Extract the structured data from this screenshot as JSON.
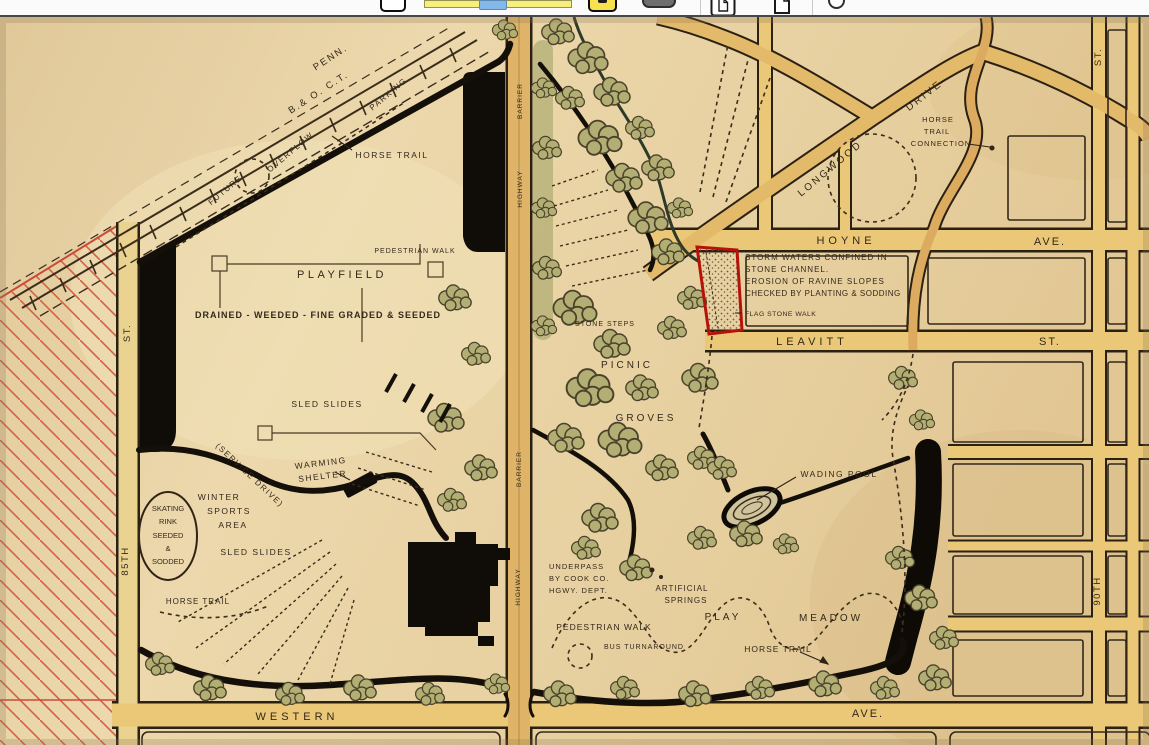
{
  "toolbar": {
    "icons": [
      "zoom-out-button",
      "zoom-slider",
      "zoom-in-button",
      "fit-width-button",
      "single-page-view-icon",
      "two-page-view-icon",
      "refresh-icon"
    ]
  },
  "map": {
    "railroad": {
      "penn": "PENN.",
      "boct": "B.& O. C.T."
    },
    "roads": {
      "future": "FUTURE",
      "overflow": "OVERFLOW",
      "parking": "PARKING",
      "longwood": "LONGWOOD",
      "drive": "DRIVE",
      "hoyne": "HOYNE",
      "hoyne_ave": "AVE.",
      "leavitt": "LEAVITT",
      "leavitt_st": "ST.",
      "western": "WESTERN",
      "western_ave": "AVE.",
      "st_left": "ST.",
      "st_85": "85TH",
      "st_right": "ST.",
      "st_90": "90TH",
      "barrier_1": "BARRIER",
      "highway_1": "HIGHWAY",
      "barrier_2": "BARRIER",
      "highway_2": "HIGHWAY"
    },
    "features": {
      "horse_trail_top": "HORSE TRAIL",
      "pedestrian_walk_top": "PEDESTRIAN WALK",
      "playfield": "PLAYFIELD",
      "drained": "DRAINED - WEEDED - FINE GRADED & SEEDED",
      "sled_slides_top": "SLED SLIDES",
      "service_drive": "(SERVICE DRIVE)",
      "warming_1": "WARMING",
      "warming_2": "SHELTER",
      "winter_1": "WINTER",
      "winter_2": "SPORTS",
      "winter_3": "AREA",
      "rink_1": "SKATING",
      "rink_2": "RINK",
      "rink_3": "SEEDED",
      "rink_4": "&",
      "rink_5": "SODDED",
      "sled_slides_bottom": "SLED SLIDES",
      "horse_trail_left": "HORSE TRAIL",
      "stone_steps": "STONE STEPS",
      "picnic": "PICNIC",
      "groves": "GROVES",
      "wading_pool": "WADING POOL",
      "underpass_1": "UNDERPASS",
      "underpass_2": "BY COOK CO.",
      "underpass_3": "HGWY. DEPT.",
      "springs_1": "ARTIFICIAL",
      "springs_2": "SPRINGS",
      "pedestrian_walk_bottom": "PEDESTRIAN WALK",
      "bus_turnaround": "BUS TURNAROUND",
      "play": "PLAY",
      "meadow": "MEADOW",
      "horse_trail_bottom": "HORSE TRAIL",
      "horse_conn_1": "HORSE",
      "horse_conn_2": "TRAIL",
      "horse_conn_3": "CONNECTION"
    },
    "annotation": {
      "line1": "STORM WATERS CONFINED IN",
      "line2": "STONE CHANNEL.",
      "line3": "EROSION OF RAVINE SLOPES",
      "line4": "CHECKED BY PLANTING & SODDING",
      "flagstone": "FLAG STONE WALK"
    },
    "colors": {
      "parchment": "#e7d2a6",
      "road": "#eac878",
      "ink": "#33281b",
      "tree": "#b2ae74",
      "red_annotation": "#b51309",
      "red_hatch": "#d4604a"
    }
  }
}
